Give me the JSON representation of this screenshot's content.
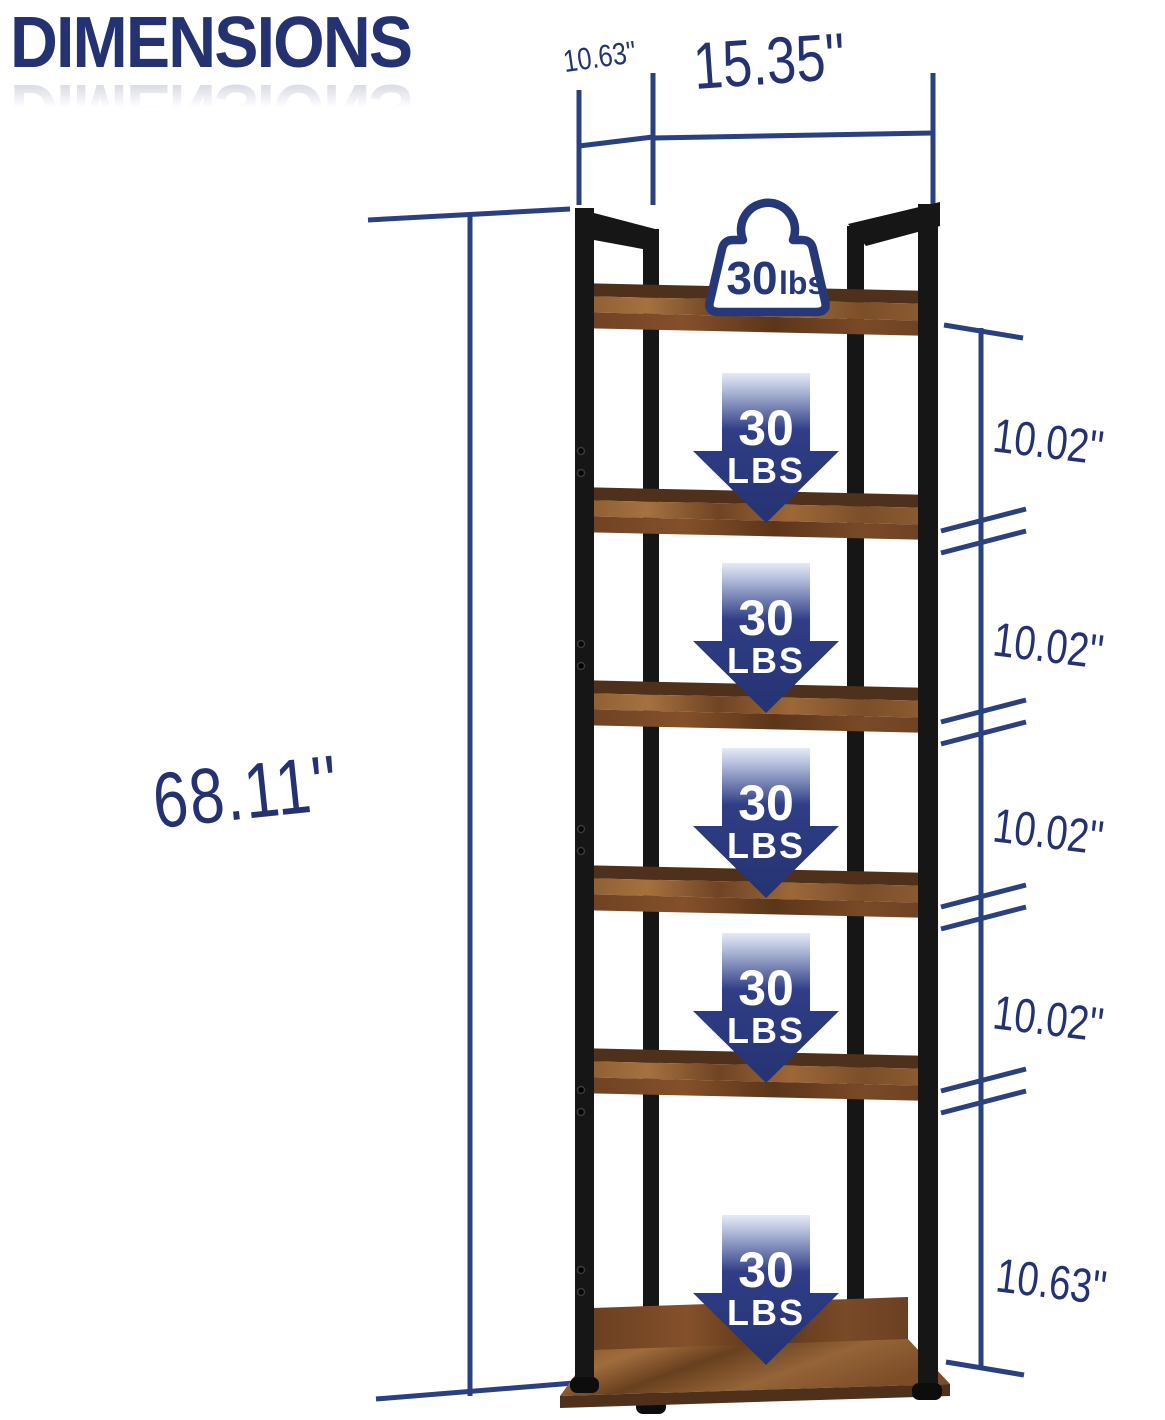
{
  "title": {
    "text": "DIMENSIONS"
  },
  "colors": {
    "navy_text": "#243271",
    "dimension_line": "#2a4080",
    "arrow_navy": "#263878",
    "wood_brown": "#8a5a30",
    "frame_black": "#161616"
  },
  "dimensions": {
    "top_depth": "10.63''",
    "top_width": "15.35''",
    "left_height": "68.11''",
    "right_segments": [
      "10.02''",
      "10.02''",
      "10.02''",
      "10.02''",
      "10.63''"
    ]
  },
  "capacity": {
    "badge": {
      "value": "30",
      "unit": "lbs"
    },
    "arrows": [
      {
        "line1": "30",
        "line2": "LBS"
      },
      {
        "line1": "30",
        "line2": "LBS"
      },
      {
        "line1": "30",
        "line2": "LBS"
      },
      {
        "line1": "30",
        "line2": "LBS"
      },
      {
        "line1": "30",
        "line2": "LBS"
      }
    ]
  }
}
